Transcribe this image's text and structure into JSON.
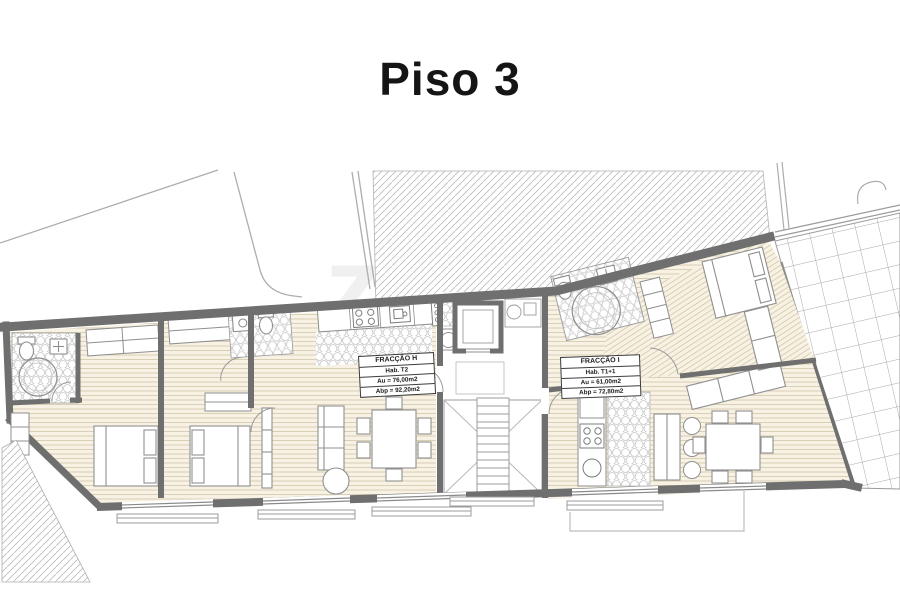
{
  "page": {
    "title": "Piso 3",
    "background": "#ffffff"
  },
  "watermark": {
    "text": "zome"
  },
  "plan": {
    "colors": {
      "wall": "#6f6f6f",
      "wood_floor": "#f7f2e3",
      "wood_line": "#d9cfb4",
      "tile_line": "#c6c6c6",
      "thin_line": "#9b9b9b",
      "hatch_line": "#bdbdbd"
    },
    "fractions": [
      {
        "name": "FRACÇÃO H",
        "habitation": "Hab. T2",
        "useful_area": "Au = 76,00m2",
        "gross_area": "Abp = 92,20m2"
      },
      {
        "name": "FRACÇÃO I",
        "habitation": "Hab. T1+1",
        "useful_area": "Au = 61,00m2",
        "gross_area": "Abp = 72,80m2"
      }
    ],
    "features": [
      "beds",
      "wardrobes",
      "sofas",
      "dining-tables",
      "chairs",
      "kitchen-counters",
      "stove",
      "sinks",
      "toilets",
      "showers",
      "stairs",
      "elevator",
      "terrace-tiles",
      "wood-flooring",
      "roof-hatching",
      "windows"
    ]
  }
}
